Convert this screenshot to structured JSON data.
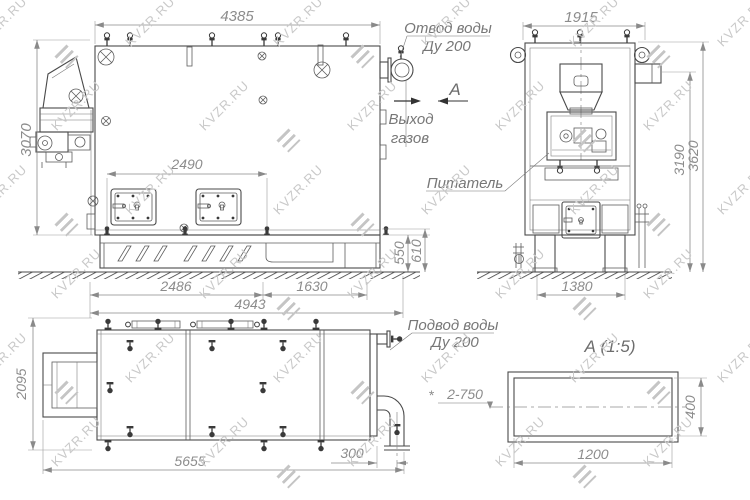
{
  "watermark": {
    "text": "KVZR.RU"
  },
  "front_view": {
    "dim_width_top": "4385",
    "dim_height_left": "3070",
    "dim_doors": "2490",
    "dim_bottom_1": "2486",
    "dim_bottom_2": "1630",
    "dim_bottom_total": "4943",
    "dim_base_1": "550",
    "dim_base_2": "610",
    "label_water_outlet_1": "Отвод воды",
    "label_water_outlet_2": "Ду 200",
    "label_gas_exit_1": "Выход",
    "label_gas_exit_2": "газов",
    "view_letter": "А"
  },
  "side_view": {
    "dim_width_top": "1915",
    "dim_height_inner": "3190",
    "dim_height_total": "3620",
    "dim_base_width": "1380",
    "label_feeder": "Питатель"
  },
  "plan_view": {
    "dim_depth_left": "2095",
    "dim_length_bottom": "5655",
    "dim_pipe_offset": "300",
    "label_water_inlet_1": "Подвод воды",
    "label_water_inlet_2": "Ду 200"
  },
  "detail_view": {
    "title": "А  (1:5)",
    "dim_width": "1200",
    "dim_height": "400",
    "ref_mark": "*",
    "ref_label": "2-750"
  }
}
